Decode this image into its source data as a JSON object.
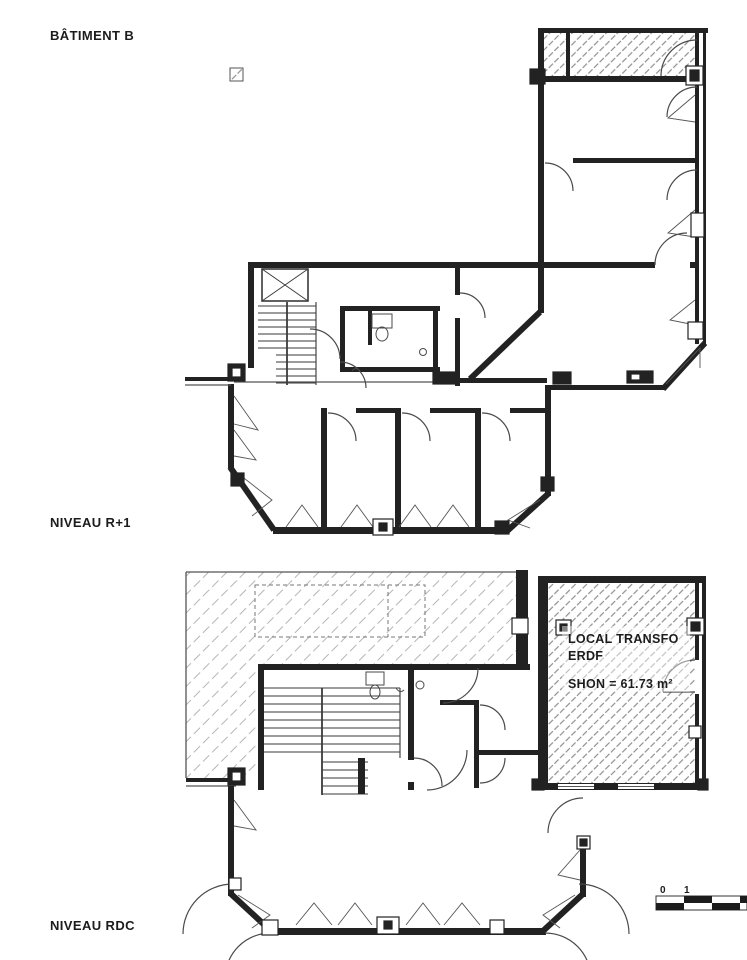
{
  "title": {
    "text": "BÂTIMENT B"
  },
  "plans": {
    "r1": {
      "label": "NIVEAU R+1"
    },
    "rdc": {
      "label": "NIVEAU RDC"
    }
  },
  "annotations": {
    "transfo_line1": "LOCAL TRANSFO",
    "transfo_line2": "ERDF",
    "transfo_area": "SHON = 61.73 m²"
  },
  "scale_bar": {
    "tick_0": "0",
    "tick_1": "1"
  },
  "colors": {
    "wall": "#222222",
    "line": "#4a4a4a",
    "thin": "#555555",
    "hatch_dense": "#8f8f8f",
    "hatch_light": "#b5b5b5",
    "text": "#1c1c1c",
    "paper": "#ffffff"
  }
}
